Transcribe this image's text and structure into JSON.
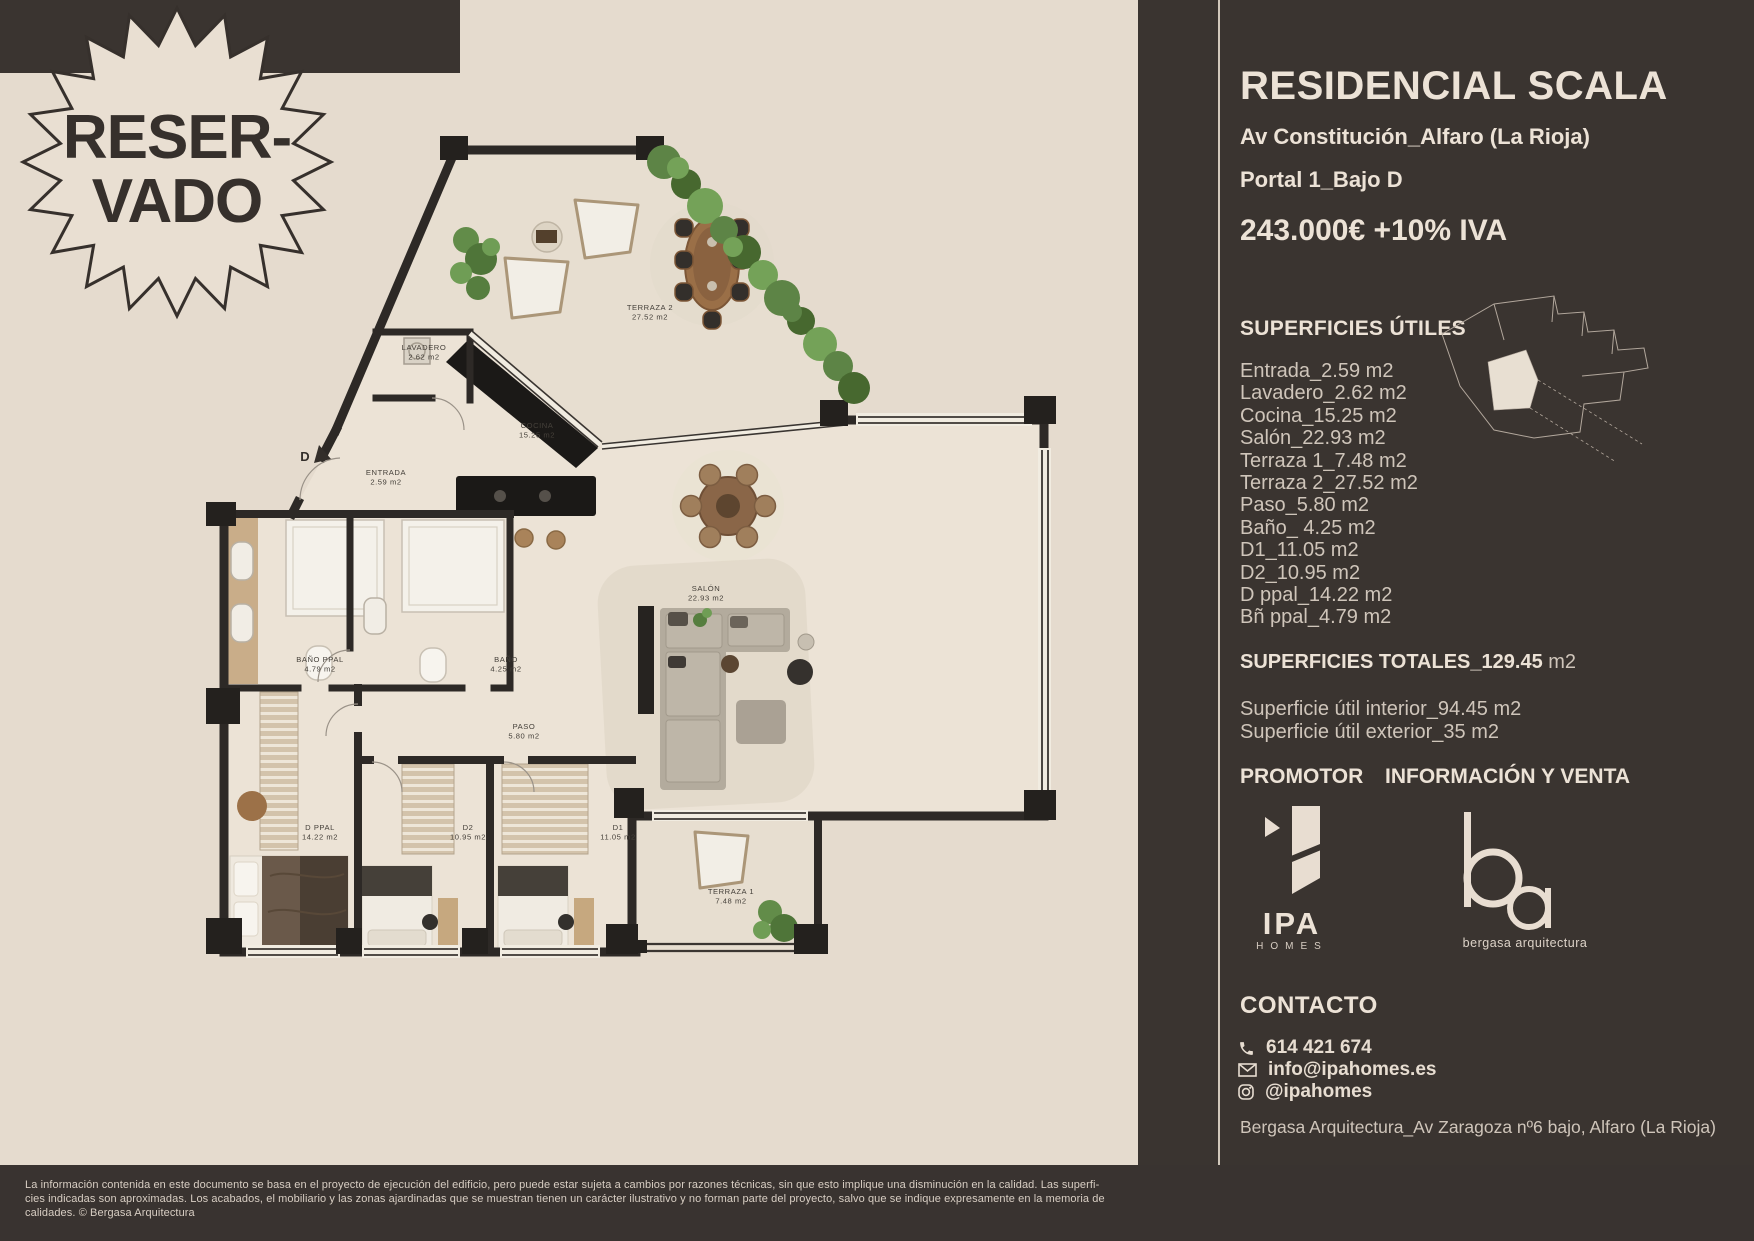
{
  "badge": {
    "line1": "RESER-",
    "line2": "VADO"
  },
  "sidebar": {
    "title": "RESIDENCIAL SCALA",
    "address": "Av Constitución_Alfaro (La Rioja)",
    "portal": "Portal 1_Bajo D",
    "price": "243.000€ +10% IVA",
    "superficies_utiles": {
      "heading": "SUPERFICIES ÚTILES",
      "items": [
        "Entrada_2.59 m2",
        "Lavadero_2.62 m2",
        "Cocina_15.25 m2",
        "Salón_22.93 m2",
        "Terraza 1_7.48 m2",
        "Terraza 2_27.52 m2",
        "Paso_5.80 m2",
        "Baño_ 4.25 m2",
        "D1_11.05 m2",
        "D2_10.95 m2",
        "D ppal_14.22 m2",
        "Bñ ppal_4.79 m2"
      ]
    },
    "totales_label": "SUPERFICIES TOTALES_129.45",
    "totales_unit": " m2",
    "interior": "Superficie útil interior_94.45 m2",
    "exterior": "Superficie útil exterior_35 m2",
    "promotor_label": "PROMOTOR",
    "venta_label": "INFORMACIÓN Y VENTA",
    "ipa_logo": {
      "name": "IPA",
      "sub": "HOMES"
    },
    "ba_logo": {
      "caption": "bergasa arquitectura"
    },
    "contacto": {
      "heading": "CONTACTO",
      "phone": "614 421 674",
      "email": "info@ipahomes.es",
      "instagram": "@ipahomes"
    },
    "footer_address": "Bergasa Arquitectura_Av Zaragoza nº6 bajo, Alfaro (La Rioja)"
  },
  "floor_plan": {
    "entrance_marker": "D",
    "rooms": [
      {
        "name": "TERRAZA 2",
        "area": "27.52 m2",
        "x": 650,
        "y": 310
      },
      {
        "name": "LAVADERO",
        "area": "2.62 m2",
        "x": 424,
        "y": 350
      },
      {
        "name": "COCINA",
        "area": "15.25 m2",
        "x": 537,
        "y": 428
      },
      {
        "name": "ENTRADA",
        "area": "2.59 m2",
        "x": 386,
        "y": 475
      },
      {
        "name": "BAÑO PPAL",
        "area": "4.79 m2",
        "x": 320,
        "y": 662
      },
      {
        "name": "BAÑO",
        "area": "4.25 m2",
        "x": 506,
        "y": 662
      },
      {
        "name": "PASO",
        "area": "5.80 m2",
        "x": 524,
        "y": 729
      },
      {
        "name": "SALÓN",
        "area": "22.93 m2",
        "x": 706,
        "y": 591
      },
      {
        "name": "D PPAL",
        "area": "14.22 m2",
        "x": 320,
        "y": 830
      },
      {
        "name": "D2",
        "area": "10.95 m2",
        "x": 468,
        "y": 830
      },
      {
        "name": "D1",
        "area": "11.05 m2",
        "x": 618,
        "y": 830
      },
      {
        "name": "TERRAZA 1",
        "area": "7.48 m2",
        "x": 731,
        "y": 894
      }
    ]
  },
  "disclaimer": {
    "lines": [
      "La información contenida en este documento se basa en el proyecto de ejecución del edificio, pero puede estar sujeta a cambios por razones técnicas, sin que esto implique una disminución en la calidad. Las superfi-",
      "cies indicadas son aproximadas. Los acabados, el mobiliario y las zonas ajardinadas que se muestran tienen un carácter ilustrativo y no forman parte del proyecto, salvo que se indique expresamente en la memoria de",
      "calidades.  © Bergasa Arquitectura"
    ]
  },
  "colors": {
    "background": "#e5dbce",
    "panel": "#3a3430",
    "wall": "#2d2926",
    "accent_text": "#ece2d6",
    "muted_text": "#cfc5ba",
    "plant_green": "#5d8446"
  }
}
